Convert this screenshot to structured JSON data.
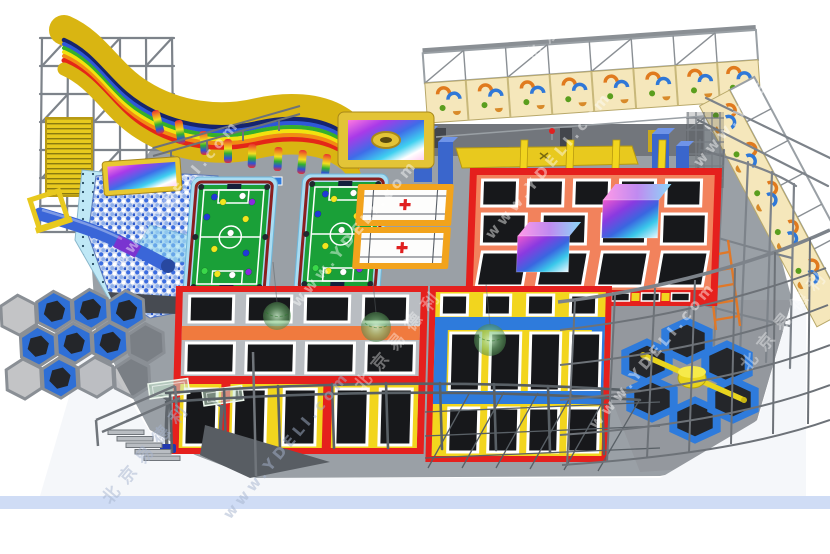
{
  "watermarks": {
    "url": "www.YDELI.com",
    "brand_cn": "北京易德利",
    "style": "diagonal translucent white text repeated across render"
  },
  "palette": {
    "background": "#ffffff",
    "floor_gray": "#9aa0a6",
    "steel_frame": "#7d838a",
    "accent_red": "#e5201d",
    "walkway_salmon": "#f2825c",
    "walkway_orange": "#f07a3e",
    "accent_yellow": "#f2d51e",
    "slide_mustard": "#d9b512",
    "accent_blue": "#2e7bdc",
    "court_border_lightblue": "#a8dcf2",
    "field_green": "#1aa038",
    "wall_cream": "#f5e7bb",
    "mat_black": "#17181b",
    "skirt_blue": "#cfdcf5",
    "wrecking_ball_green": "rgba(120,190,120,0.6)"
  },
  "zones": [
    {
      "id": "rainbow-wave-slide",
      "desc": "yellow wave slide with rainbow stripes on gray steel tower"
    },
    {
      "id": "landing-airbag",
      "desc": "yellow framed rainbow airbag with donut ring"
    },
    {
      "id": "ball-pit",
      "desc": "blue and white ball pool with blue tube slide and yellow entry frame"
    },
    {
      "id": "projection-screen",
      "desc": "yellow framed rainbow interactive screen above ball pit"
    },
    {
      "id": "honeycomb-climber",
      "desc": "hexagonal steel cells with blue pads",
      "cells": 12
    },
    {
      "id": "snookball-courts",
      "desc": "green soccer-billiards tables with colored balls",
      "count": 2
    },
    {
      "id": "white-courts",
      "desc": "white courts with orange border and red cross",
      "count": 2
    },
    {
      "id": "free-jump-grid",
      "desc": "red and salmon trampoline grid with foam cubes",
      "mats": 13,
      "foam_cubes": 2,
      "yellow_posts": 4
    },
    {
      "id": "main-trampoline-block-left",
      "desc": "red framed grid with gray and orange walkways and yellow lanes",
      "mats": 13
    },
    {
      "id": "main-trampoline-block-right",
      "desc": "yellow lane grid with blue bands",
      "mats": 12
    },
    {
      "id": "wrecking-balls",
      "desc": "translucent green hanging balls",
      "count": 3
    },
    {
      "id": "basketball-hoops",
      "desc": "mini hoops with translucent backboards",
      "count": 2
    },
    {
      "id": "wipeout-hexagons",
      "desc": "blue hexagon trampolines with yellow rotating sweeper",
      "hexes": 6
    },
    {
      "id": "climbing-traverse-wall",
      "desc": "cream wall bays with orange, blue and green holds",
      "bays": 13
    },
    {
      "id": "zip-line",
      "desc": "cable across the hall with red trolley marker"
    },
    {
      "id": "tumble-track",
      "desc": "yellow runway along back wall"
    },
    {
      "id": "safety-netting",
      "desc": "gray steel lattice frames and net fences around park"
    }
  ]
}
